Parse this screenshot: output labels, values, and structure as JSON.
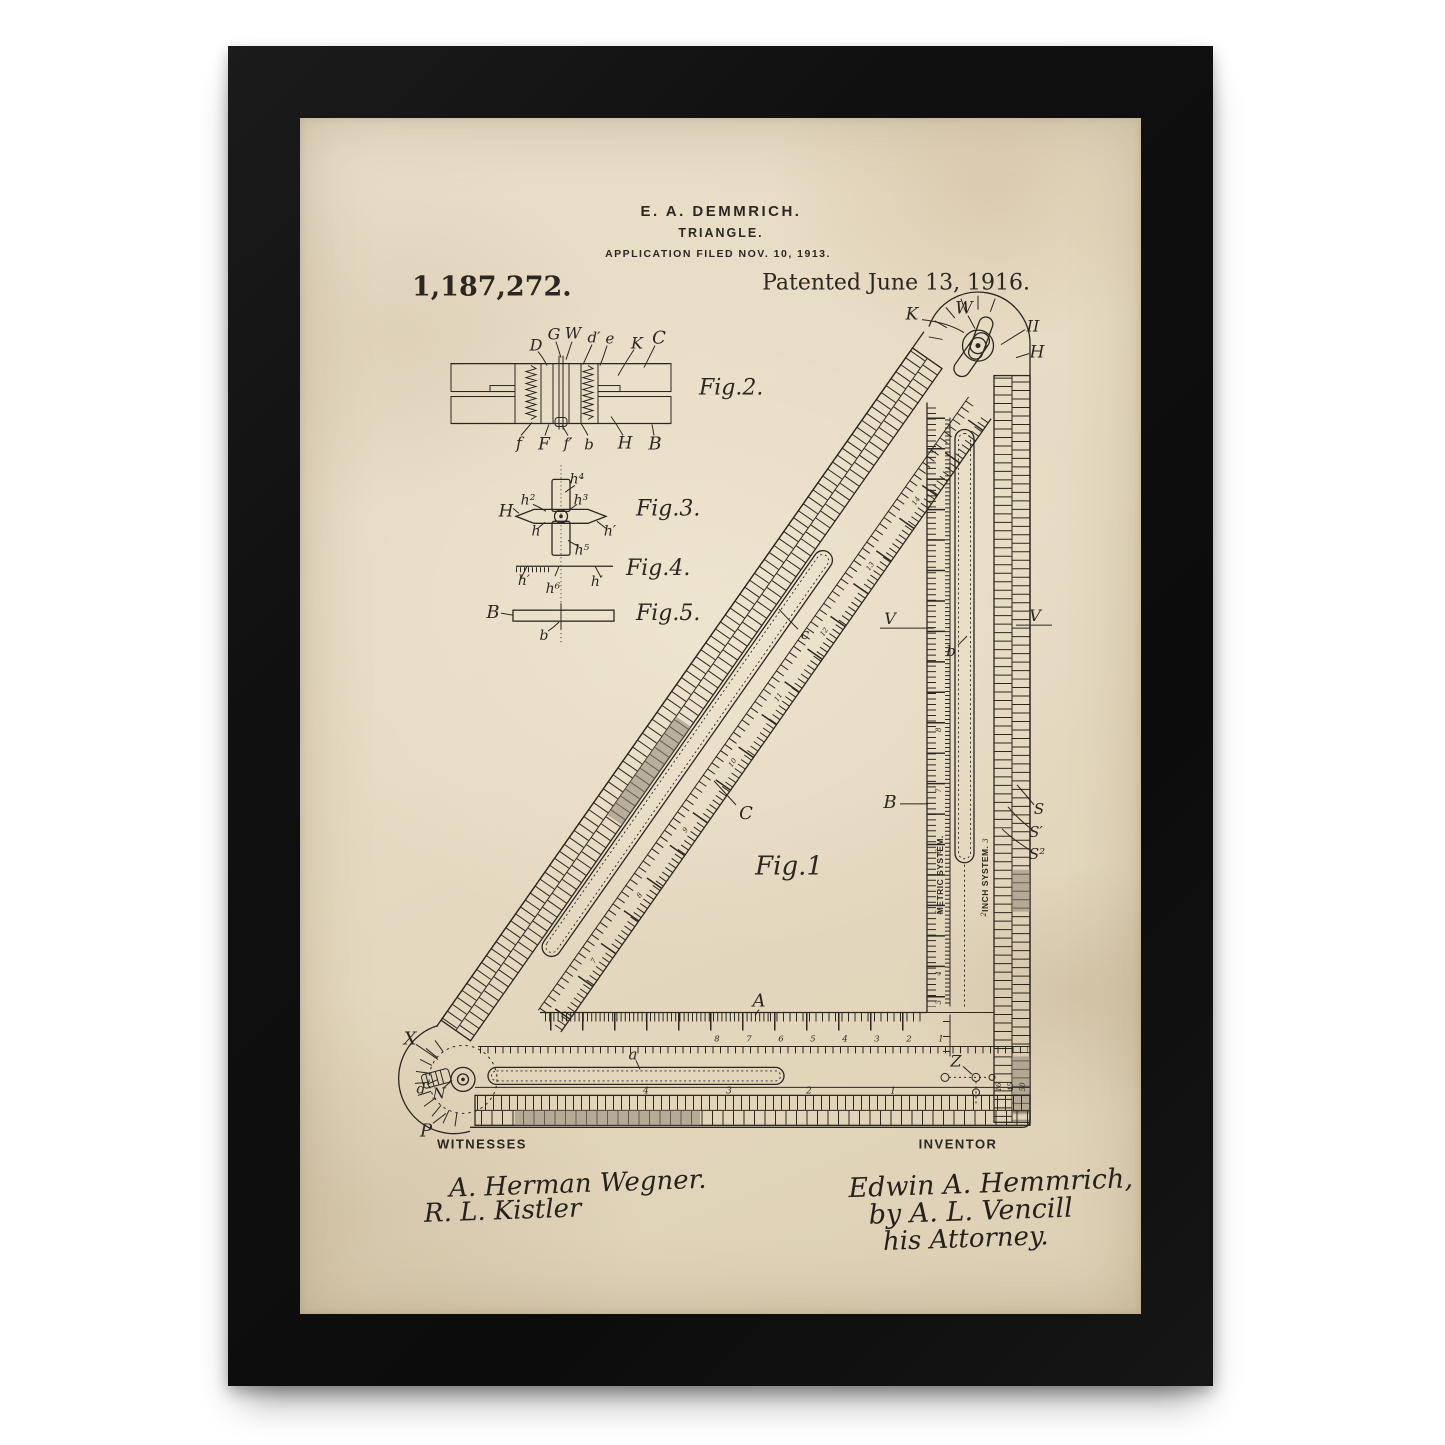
{
  "colors": {
    "background": "#ffffff",
    "frame": "#121212",
    "paper": "#e6dbc2",
    "ink": "#2b2722"
  },
  "header": {
    "inventor": "E. A. DEMMRICH.",
    "title": "TRIANGLE.",
    "application": "APPLICATION FILED NOV. 10, 1913.",
    "patent_number": "1,187,272.",
    "patented": "Patented June 13, 1916."
  },
  "figures": {
    "fig1": {
      "label": "Fig.1",
      "callouts": {
        "k": "K",
        "w": "W",
        "ii": "II",
        "h": "H",
        "v_left": "V",
        "v_right": "V",
        "b_slot": "b",
        "c_slot": "c",
        "c_arm": "C",
        "b_arm": "B",
        "a_arm": "A",
        "a_slot": "a",
        "z": "Z",
        "x": "X",
        "d": "d",
        "n": "N",
        "p": "P",
        "s": "S",
        "s1": "S′",
        "s2": "S²"
      },
      "scales": {
        "metric_label": "METRIC SYSTEM.",
        "inch_label": "INCH SYSTEM.",
        "bottom_numbers": [
          "8",
          "7",
          "6",
          "5",
          "4",
          "3",
          "2",
          "1"
        ],
        "rack_numbers": [
          "4",
          "3",
          "2",
          "1"
        ],
        "metric_numbers": [
          "8",
          "7",
          "6",
          "5",
          "4",
          "3"
        ],
        "hyp_numbers": [
          "7",
          "8",
          "9",
          "10",
          "11",
          "12",
          "13",
          "14"
        ],
        "inch_numbers": [
          "3",
          "2"
        ],
        "corner_numbers": [
          "16",
          "45",
          "50"
        ]
      }
    },
    "fig2": {
      "label": "Fig.2.",
      "top": {
        "d": "D",
        "g": "G",
        "w": "W",
        "dp": "d′",
        "e": "e",
        "k": "K",
        "c": "C"
      },
      "bottom": {
        "f": "f",
        "fc": "F",
        "fp": "f′",
        "b": "b",
        "h": "H",
        "bc": "B"
      }
    },
    "fig3": {
      "label": "Fig.3.",
      "callouts": {
        "hc": "H",
        "h2": "h²",
        "h4": "h⁴",
        "h3": "h³",
        "h": "h",
        "hp": "h′",
        "h5": "h⁵"
      }
    },
    "fig4": {
      "label": "Fig.4.",
      "callouts": {
        "hp_l": "h′",
        "h6": "h⁶",
        "hp_r": "h′"
      }
    },
    "fig5": {
      "label": "Fig.5.",
      "callouts": {
        "b_cap": "B",
        "b": "b"
      }
    }
  },
  "footer": {
    "witnesses_label": "WITNESSES",
    "witness1": "A. Herman Wegner.",
    "witness2": "R. L. Kistler",
    "inventor_label": "INVENTOR",
    "inventor_sig": "Edwin A. Hemmrich,",
    "by_line": "by A. L. Vencill",
    "attorney": "his Attorney."
  }
}
